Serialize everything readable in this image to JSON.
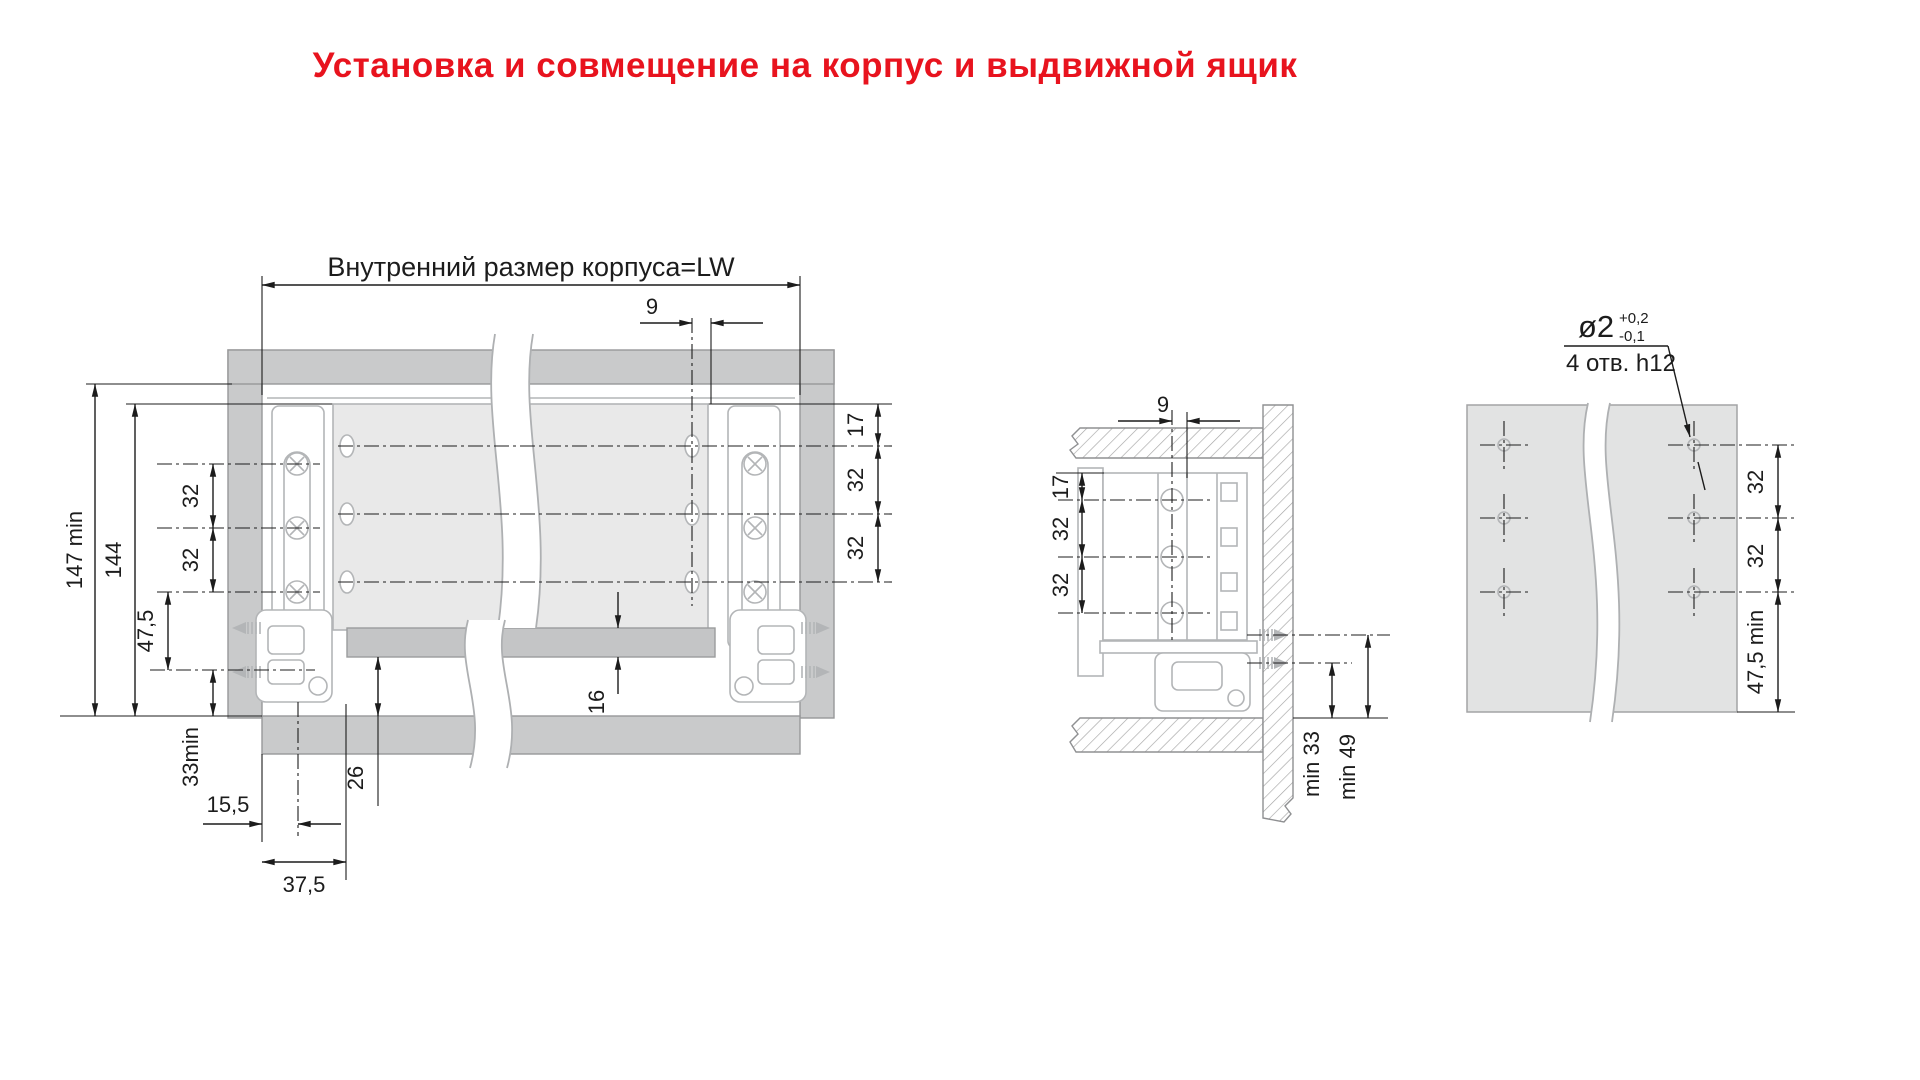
{
  "title": "Установка и совмещение на корпус и выдвижной ящик",
  "front_view": {
    "dim_lw": "Внутренний размер корпуса=LW",
    "dim_9": "9",
    "dim_147min": "147 min",
    "dim_144": "144",
    "dim_32_a": "32",
    "dim_32_b": "32",
    "dim_47_5": "47,5",
    "dim_33min": "33min",
    "dim_15_5": "15,5",
    "dim_37_5": "37,5",
    "dim_26": "26",
    "dim_16": "16",
    "dim_17": "17",
    "dim_32_c": "32",
    "dim_32_d": "32"
  },
  "section_view": {
    "dim_9": "9",
    "dim_17": "17",
    "dim_32_a": "32",
    "dim_32_b": "32",
    "dim_min33": "min 33",
    "dim_min49": "min 49"
  },
  "drill_view": {
    "dim_dia": "ø2",
    "dim_tol_plus": "+0,2",
    "dim_tol_minus": "-0,1",
    "dim_holes": "4 отв. h12",
    "dim_32_a": "32",
    "dim_32_b": "32",
    "dim_47_5min": "47,5 min"
  },
  "colors": {
    "title_red": "#e8131e",
    "panel_gray": "#c9cacb",
    "drawer_gray": "#e9e9e9"
  }
}
